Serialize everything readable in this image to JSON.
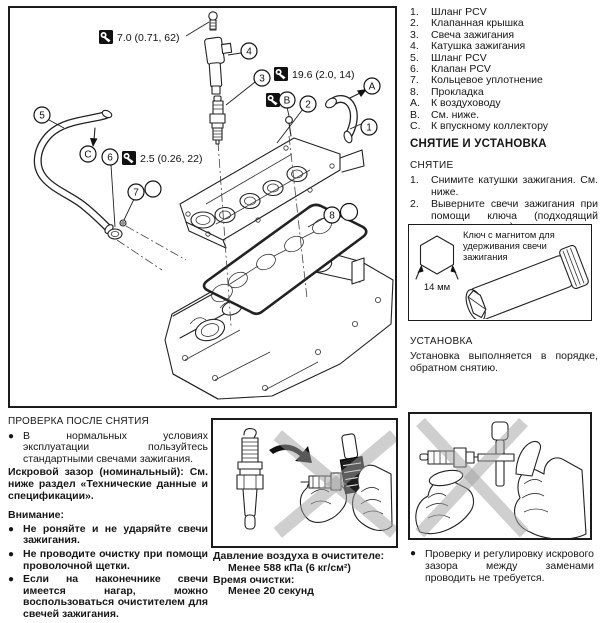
{
  "diagram": {
    "torque_labels": [
      "7.0 (0.71, 62)",
      "19.6 (2.0, 14)",
      "2.5 (0.26, 22)"
    ],
    "callouts": {
      "c1": "1",
      "c2": "2",
      "c3": "3",
      "c4": "4",
      "c5": "5",
      "c6": "6",
      "c7": "7",
      "c8": "8",
      "cA": "A",
      "cB": "B",
      "cC": "C"
    }
  },
  "parts_list": [
    {
      "num": "1.",
      "label": "Шланг PCV"
    },
    {
      "num": "2.",
      "label": "Клапанная крышка"
    },
    {
      "num": "3.",
      "label": "Свеча зажигания"
    },
    {
      "num": "4.",
      "label": "Катушка зажигания"
    },
    {
      "num": "5.",
      "label": "Шланг PCV"
    },
    {
      "num": "6.",
      "label": "Клапан PCV"
    },
    {
      "num": "7.",
      "label": "Кольцевое уплотнение"
    },
    {
      "num": "8.",
      "label": "Прокладка"
    },
    {
      "num": "A.",
      "label": "К воздуховоду"
    },
    {
      "num": "B.",
      "label": "См. ниже."
    },
    {
      "num": "C.",
      "label": "К впускному коллектору"
    }
  ],
  "removal_install": {
    "title": "СНЯТИЕ И УСТАНОВКА",
    "removal_heading": "СНЯТИЕ",
    "steps": [
      {
        "num": "1.",
        "text": "Снимите катушки зажигания. См. ниже."
      },
      {
        "num": "2.",
        "text": "Выверните свечи зажигания при помощи ключа (подходящий специнструмент)."
      }
    ],
    "install_heading": "УСТАНОВКА",
    "install_text": "Установка выполняется в порядке, обратном снятию."
  },
  "socket_box": {
    "caption": "Ключ с магнитом для удерживания свечи зажигания",
    "size_label": "14 мм"
  },
  "inspection": {
    "heading": "ПРОВЕРКА ПОСЛЕ СНЯТИЯ",
    "bullet1": "В нормальных условиях эксплуатации пользуйтесь стандартными свечами зажигания.",
    "gap_note": "Искровой зазор (номинальный): См. ниже раздел «Технические данные и спецификации».",
    "attention_heading": "Внимание:",
    "attention_bullets": [
      "Не роняйте и не ударяйте свечи зажигания.",
      "Не проводите очистку при помощи проволочной щетки.",
      "Если на наконечнике свечи имеется нагар, можно воспользоваться очистителем для свечей зажигания."
    ]
  },
  "cleaner_spec": {
    "line1": "Давление воздуха в очистителе:",
    "line2": "Менее 588 кПа (6 кг/см²)",
    "line3": "Время очистки:",
    "line4": "Менее 20 секунд"
  },
  "gap_check_note": "Проверку и регулировку искрового зазора между заменами проводить не требуется.",
  "bullet_char": "●"
}
